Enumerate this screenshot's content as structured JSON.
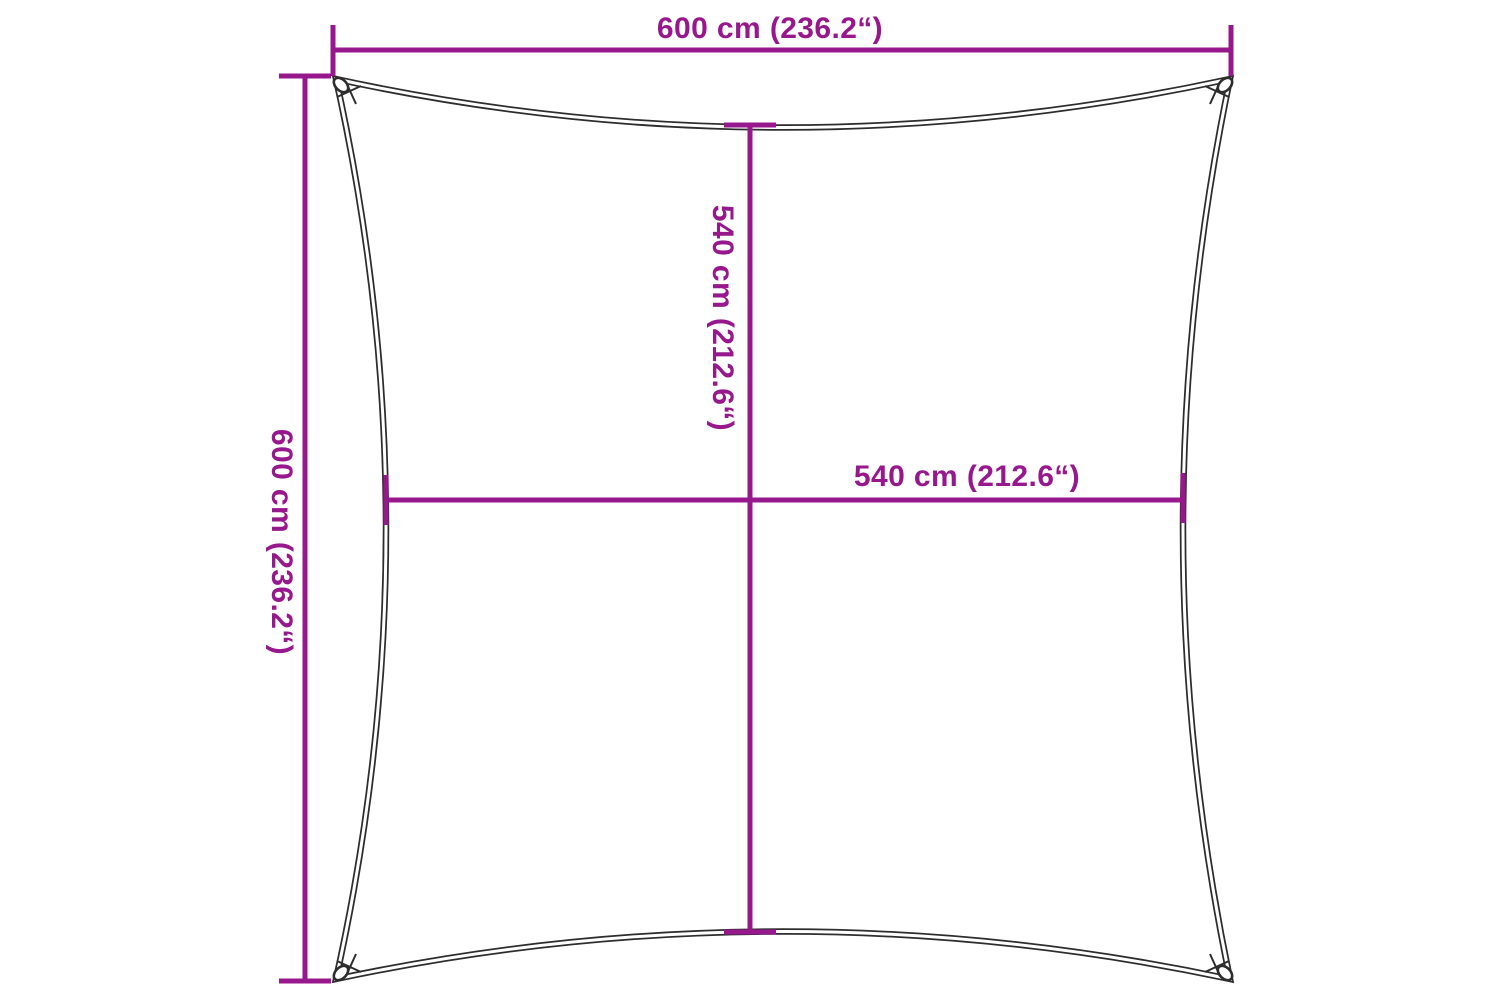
{
  "colors": {
    "accent": "#97188c",
    "outline": "#2d2d2d",
    "background": "#ffffff"
  },
  "diagram": {
    "name": "square-shade-sail-dimension-diagram",
    "shape": "square sail with concave edges and corner attachment rings",
    "labels": {
      "top_width": "600 cm (236.2“)",
      "left_height": "600 cm (236.2“)",
      "center_height": "540 cm (212.6“)",
      "center_width": "540 cm (212.6“)"
    }
  }
}
